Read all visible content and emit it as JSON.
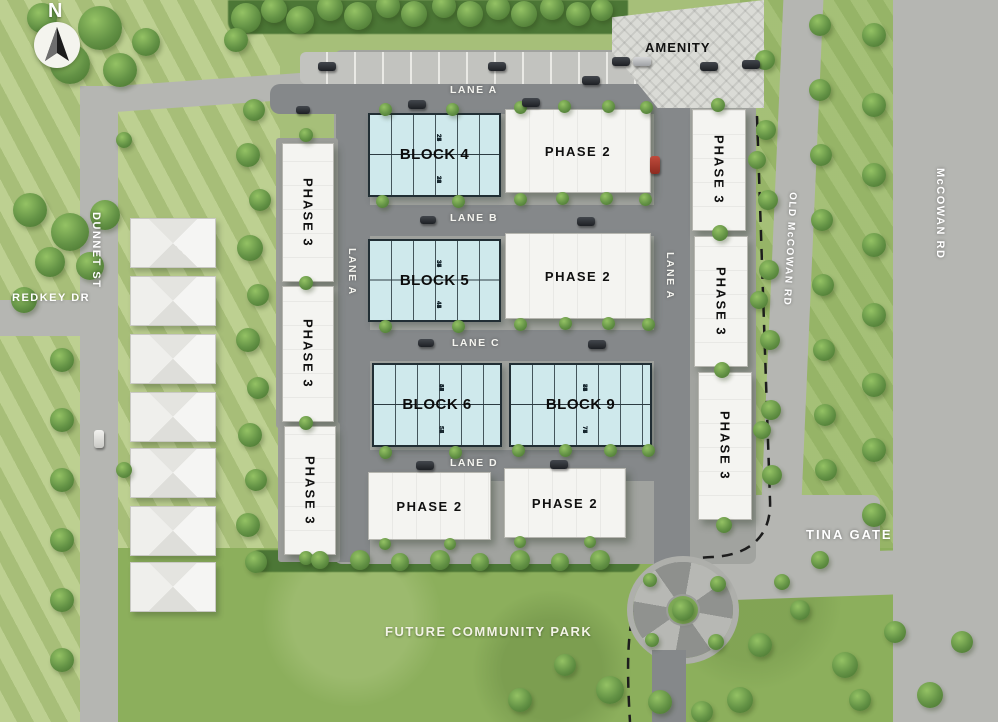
{
  "compass": {
    "north_label": "N"
  },
  "streets": {
    "dunnet_st": "DUNNET ST",
    "redkey_dr": "REDKEY DR",
    "mccowan_rd": "McCOWAN RD",
    "old_mccowan_rd": "OLD McCOWAN RD",
    "tina_gate": "TINA GATE"
  },
  "lanes": {
    "lane_a_top": "LANE A",
    "lane_a_west": "LANE A",
    "lane_a_east": "LANE A",
    "lane_b": "LANE B",
    "lane_c": "LANE C",
    "lane_d": "LANE D"
  },
  "areas": {
    "amenity": "AMENITY",
    "future_park": "FUTURE COMMUNITY PARK"
  },
  "phase_labels": {
    "phase2": "PHASE 2",
    "phase3": "PHASE 3"
  },
  "blocks": [
    {
      "id": "block4",
      "label": "BLOCK 4",
      "units_top": [
        "22 23",
        "24 25",
        "26 27"
      ],
      "units_bottom": [
        "33 32",
        "31 30",
        "29 28"
      ]
    },
    {
      "id": "block5",
      "label": "BLOCK 5",
      "units_top": [
        "34 35",
        "36 37",
        "38 39"
      ],
      "units_bottom": [
        "45 44",
        "43 42",
        "41 40"
      ]
    },
    {
      "id": "block6",
      "label": "BLOCK 6",
      "units_top": [
        "46 47",
        "48 49",
        "50 51"
      ],
      "units_bottom": [
        "57 56",
        "55 54",
        "53 52"
      ]
    },
    {
      "id": "block9",
      "label": "BLOCK 9",
      "units_top": [
        "79 80",
        "81 82",
        "83 84",
        "85"
      ],
      "units_bottom": [
        "78 77",
        "76 75",
        "74 73",
        "72"
      ]
    }
  ],
  "colors": {
    "grass": "#a6bf79",
    "park_green": "#8caf5c",
    "road_gray": "#b5b6b2",
    "lane_gray": "#85888a",
    "block_blue": "#cfe9ec",
    "building_white": "#f4f4f1",
    "tree_green": "#639245",
    "boundary_dash": "#1d1d1d",
    "label_white": "#ffffff",
    "label_black": "#101010"
  }
}
